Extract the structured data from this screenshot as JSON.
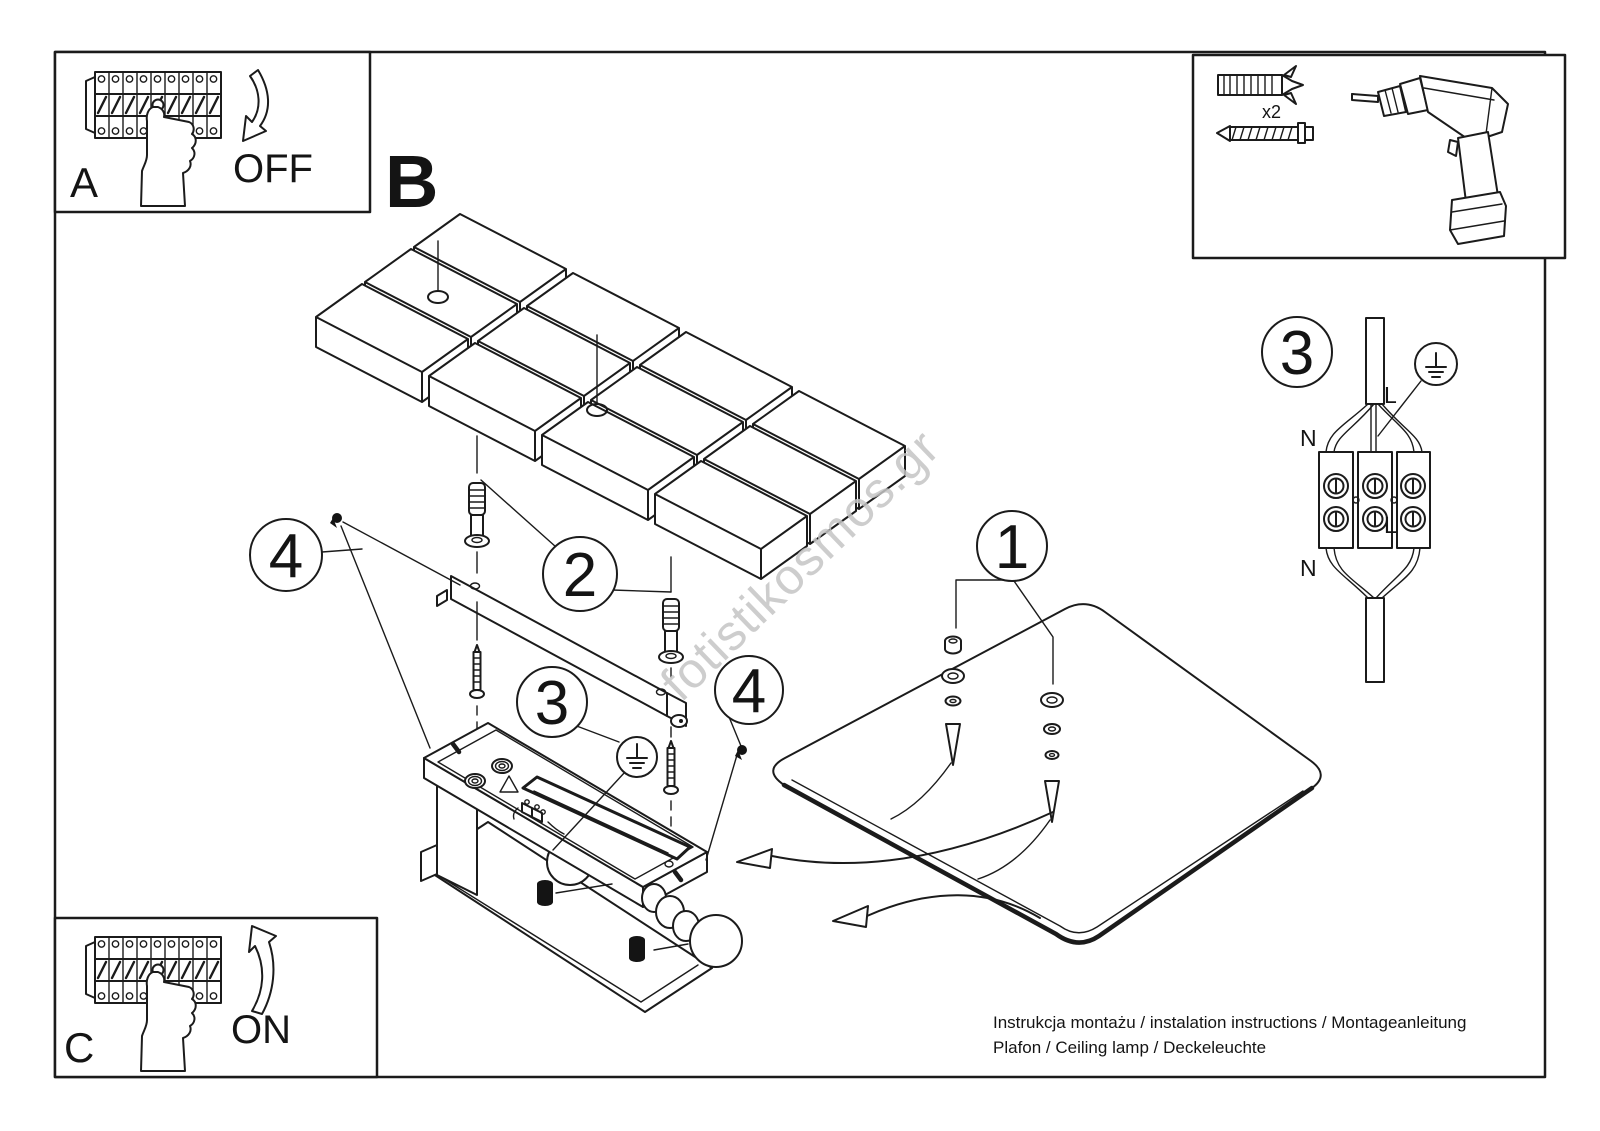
{
  "steps": {
    "a": "A",
    "b": "B",
    "c": "C"
  },
  "actions": {
    "off": "OFF",
    "on": "ON"
  },
  "tools": {
    "wall_plug_qty": "x2"
  },
  "callouts": {
    "n1": "1",
    "n2": "2",
    "n3": "3",
    "n4": "4"
  },
  "wiring": {
    "n_top": "N",
    "n_bottom": "N",
    "l_top": "L",
    "l_bottom": "L"
  },
  "footer": {
    "line1": "Instrukcja montażu / instalation instructions / Montageanleitung",
    "line2": "Plafon / Ceiling lamp / Deckeleuchte"
  },
  "watermark": "fotistikosmos.gr",
  "colors": {
    "ink": "#1b1b1b",
    "watermark": "#c5c5c5",
    "paper": "#ffffff"
  }
}
